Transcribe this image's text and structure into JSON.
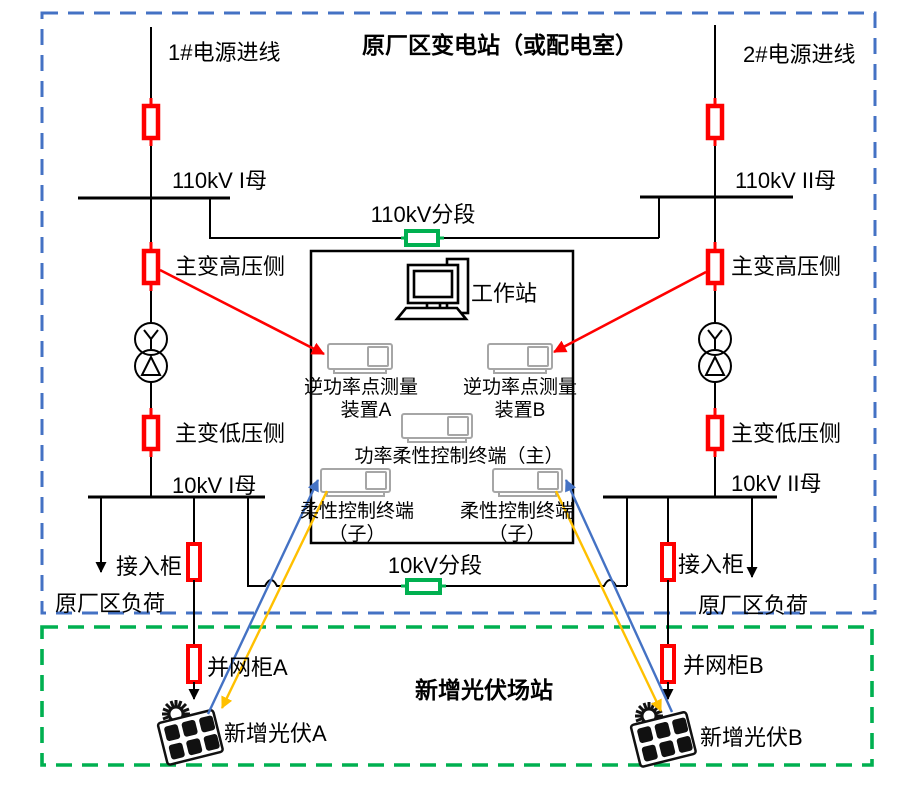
{
  "substation": {
    "title": "原厂区变电站（或配电室）",
    "feeder_1": "1#电源进线",
    "feeder_2": "2#电源进线",
    "bus_110kv_1": "110kV I母",
    "bus_110kv_2": "110kV II母",
    "tie_110kv": "110kV分段",
    "tf_hv_side": "主变高压侧",
    "tf_lv_side": "主变低压侧",
    "bus_10kv_1": "10kV I母",
    "bus_10kv_2": "10kV II母",
    "tie_10kv": "10kV分段",
    "incoming_cabinet": "接入柜",
    "plant_load": "原厂区负荷"
  },
  "control_room": {
    "workstation": "工作站",
    "meas_device_line1": "逆功率点测量",
    "meas_device_a_line2": "装置A",
    "meas_device_b_line2": "装置B",
    "master_terminal": "功率柔性控制终端（主）",
    "sub_terminal_line1": "柔性控制终端",
    "sub_terminal_line2": "（子）"
  },
  "pv_station": {
    "title": "新增光伏场站",
    "grid_cabinet_a": "并网柜A",
    "grid_cabinet_b": "并网柜B",
    "pv_a": "新增光伏A",
    "pv_b": "新增光伏B"
  },
  "colors": {
    "substation_border": "#4472C4",
    "pv_station_border": "#00B050",
    "breaker": "#FF0000",
    "tie_breaker": "#00B050",
    "measure_arrow": "#FF0000",
    "control_arrow_up": "#4472C4",
    "control_arrow_down": "#FFC000"
  }
}
